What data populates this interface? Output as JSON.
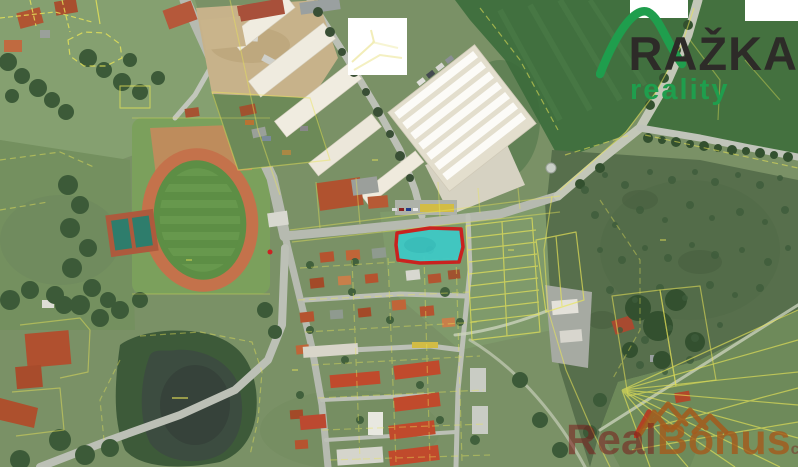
{
  "page": {
    "type": "aerial-cadastral-map"
  },
  "logo": {
    "name": "RAŽKA",
    "subtitle": "reality",
    "name_color": "#2d2b28",
    "green": "#1f9e4d"
  },
  "watermark": {
    "part1": "Real",
    "part2": "Bonus",
    "suffix": "cz",
    "dark_red": "#7a1d1d",
    "orange": "#a55a1c"
  },
  "map": {
    "highlight_parcel": {
      "fill": "#3fc9c6",
      "stroke": "#ce1c1c"
    },
    "cadastral_color": "#e9e558"
  }
}
